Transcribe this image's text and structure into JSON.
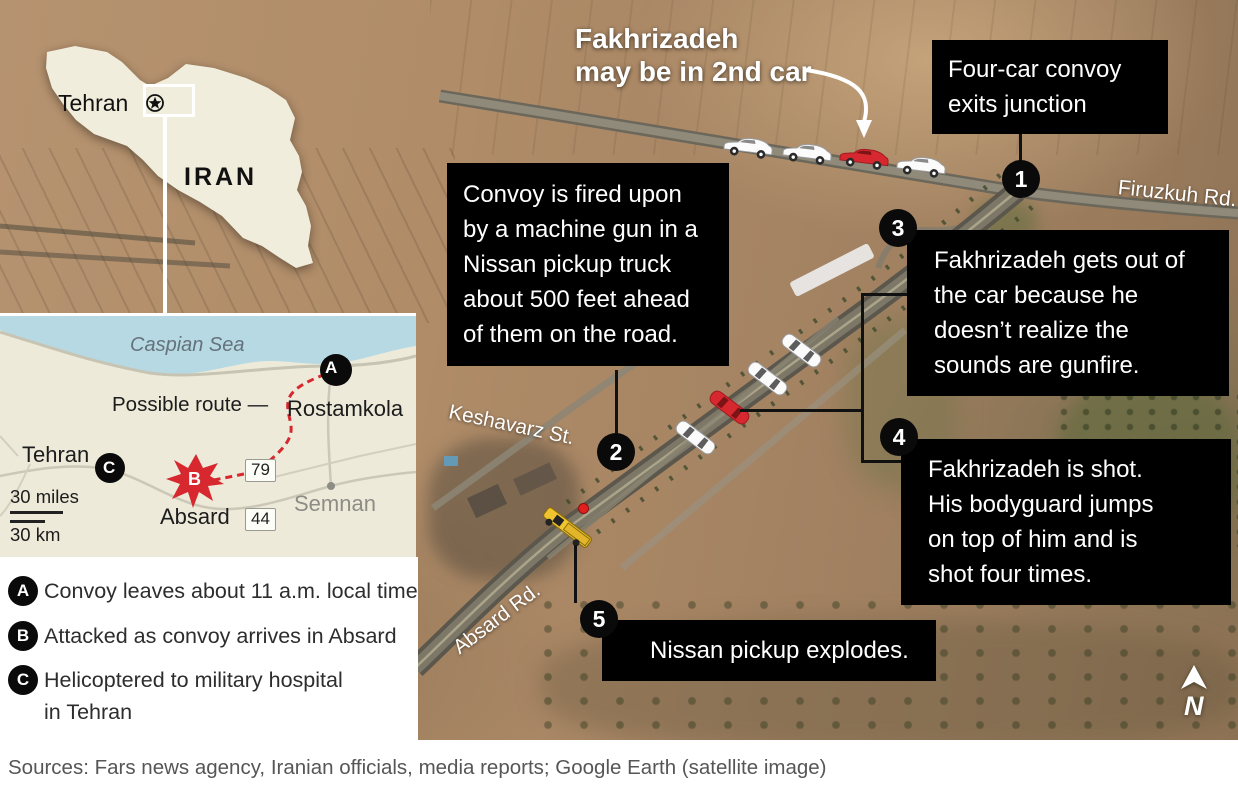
{
  "inset": {
    "city": "Tehran",
    "country": "IRAN"
  },
  "map": {
    "sea": "Caspian Sea",
    "route_label": "Possible route —",
    "rostamkola": "Rostamkola",
    "tehran": "Tehran",
    "absard": "Absard",
    "semnan": "Semnan",
    "shield_79": "79",
    "shield_44": "44",
    "marker_a": "A",
    "marker_b": "B",
    "marker_c": "C",
    "scale_miles": "30 miles",
    "scale_km": "30 km"
  },
  "legend": {
    "a_marker": "A",
    "a_text": "Convoy leaves about 11 a.m. local time",
    "b_marker": "B",
    "b_text": "Attacked as convoy arrives in Absard",
    "c_marker": "C",
    "c_line1": "Helicoptered to military hospital",
    "c_line2": "in Tehran"
  },
  "callouts": {
    "fakh_line1": "Fakhrizadeh",
    "fakh_line2": "may be in 2nd car",
    "n1": "1",
    "t1": "Four-car convoy exits junction",
    "n2": "2",
    "t2": "Convoy is fired upon by a machine gun in a Nissan pickup truck about 500 feet ahead of them on the road.",
    "n3": "3",
    "t3": "Fakhrizadeh gets out of the car because he doesn’t realize the sounds are gunfire.",
    "n4": "4",
    "t4": "Fakhrizadeh is shot. His bodyguard jumps on top of him and is shot four times.",
    "n5": "5",
    "t5": "Nissan pickup explodes."
  },
  "roads": {
    "firuzkuh": "Firuzkuh Rd.",
    "keshavarz": "Keshavarz St.",
    "absard_rd": "Absard Rd."
  },
  "compass_n": "N",
  "source": "Sources: Fars news agency, Iranian officials, media reports; Google Earth (satellite image)",
  "colors": {
    "accent_red": "#d6282e",
    "sea_blue": "#b7d9e3",
    "map_bg": "#edeada",
    "box_bg": "#000000",
    "truck_yellow": "#f0c42f"
  }
}
